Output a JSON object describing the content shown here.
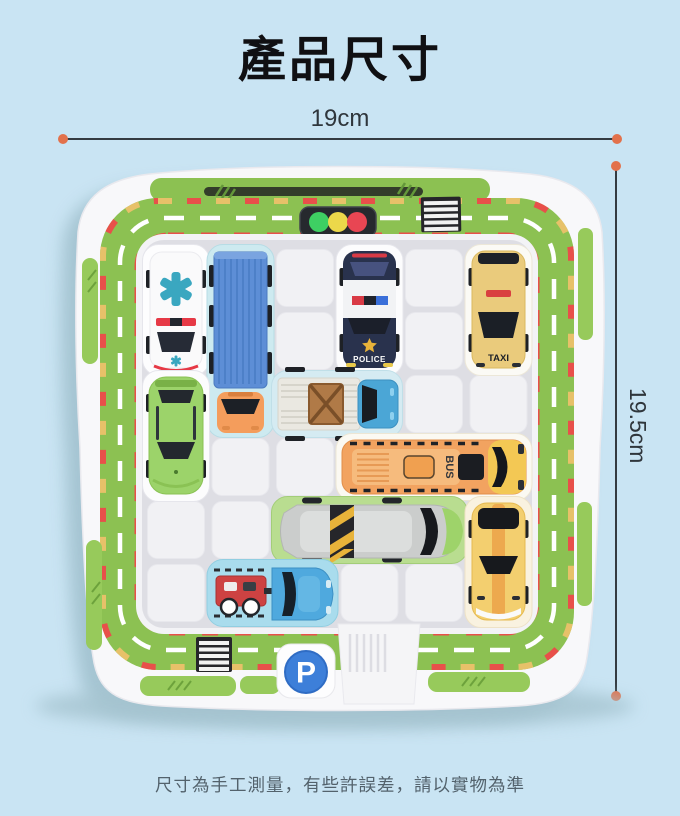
{
  "page": {
    "title": "產品尺寸",
    "footer_note": "尺寸為手工測量，有些許誤差，請以實物為準",
    "background_color": "#c9e4f3"
  },
  "dimensions": {
    "width_label": "19cm",
    "height_label": "19.5cm",
    "accent_color": "#e2714b",
    "line_color": "#343b41"
  },
  "board": {
    "description": "white plastic sliding-car parking puzzle board with green road ring",
    "grid": {
      "rows": 6,
      "cols": 6
    },
    "road_colors": {
      "green": "#8cc152",
      "red_dash": "#e8504a",
      "yellow_dash": "#e7c169",
      "center_dash": "#ffffff"
    },
    "traffic_light": [
      "#3ecf63",
      "#ecd84a",
      "#e84653"
    ],
    "signs": {
      "parking_label": "P"
    },
    "pieces": [
      {
        "id": "ambulance",
        "type": "ambulance",
        "orientation": "vertical",
        "col": 1,
        "row": 1,
        "length": 2,
        "color": "#fbfbfc"
      },
      {
        "id": "container-truck",
        "type": "truck-with-cab",
        "orientation": "vertical",
        "col": 2,
        "row": 1,
        "length": 3,
        "color": "#5d8ed6"
      },
      {
        "id": "police-car",
        "type": "police-car",
        "orientation": "vertical",
        "col": 4,
        "row": 1,
        "length": 2,
        "color": "#29324d",
        "label": "POLICE"
      },
      {
        "id": "taxi",
        "type": "taxi",
        "orientation": "vertical",
        "col": 6,
        "row": 1,
        "length": 2,
        "color": "#eacb7c",
        "label": "TAXI"
      },
      {
        "id": "green-sports-car",
        "type": "sports-car",
        "orientation": "vertical",
        "col": 1,
        "row": 3,
        "length": 2,
        "color": "#9cd36a"
      },
      {
        "id": "flatbed-truck",
        "type": "flatbed-truck-with-crate",
        "orientation": "horizontal",
        "col": 3,
        "row": 3,
        "length": 2,
        "color": "#4ba6d6"
      },
      {
        "id": "bus",
        "type": "bus",
        "orientation": "horizontal",
        "col": 4,
        "row": 4,
        "length": 3,
        "color": "#f2a360",
        "label": "BUS"
      },
      {
        "id": "race-car",
        "type": "covered-race-car",
        "orientation": "horizontal",
        "col": 3,
        "row": 5,
        "length": 3,
        "color": "#cbcdcc"
      },
      {
        "id": "car-with-cart",
        "type": "car-towing-cart",
        "orientation": "horizontal",
        "col": 2,
        "row": 6,
        "length": 2,
        "color": "#4fa9de"
      },
      {
        "id": "yellow-sports-car",
        "type": "sports-car",
        "orientation": "vertical",
        "col": 6,
        "row": 5,
        "length": 2,
        "color": "#f3cf6f"
      }
    ]
  }
}
